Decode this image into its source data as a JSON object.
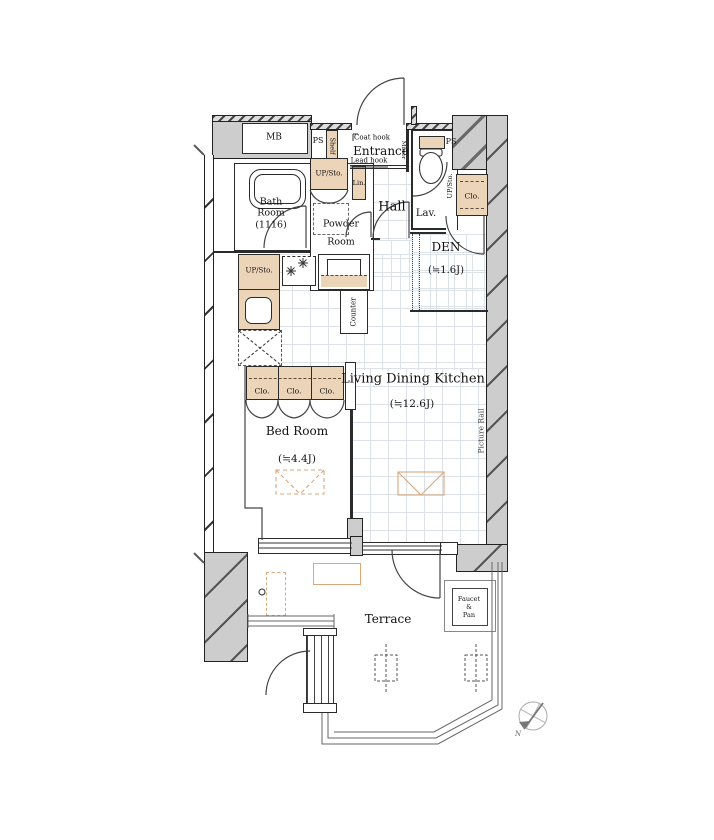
{
  "labels": {
    "mb": "MB",
    "ps_left": "PS",
    "ps_right": "PS",
    "shelf": "Shelf",
    "coat_hook": "Coat hook",
    "lead_hook": "Lead hook",
    "mirror": "Mirror",
    "entrance": "Entrance",
    "upsto_entrance": "UP/Sto.",
    "lin": "Lin.",
    "hall": "Hall",
    "lav": "Lav.",
    "upsto_lav": "UP/Sto.",
    "clo_lav": "Clo.",
    "bath_1": "Bath",
    "bath_2": "Room",
    "bath_3": "(1116)",
    "powder_1": "Powder",
    "powder_2": "Room",
    "den": "DEN",
    "den_size": "(≒1.6J)",
    "upsto_kitchen": "UP/Sto.",
    "counter": "Counter",
    "ldk": "Living Dining Kitchen",
    "ldk_size": "(≒12.6J)",
    "picture_rail": "Picture Rail",
    "clo_1": "Clo.",
    "clo_2": "Clo.",
    "clo_3": "Clo.",
    "bed": "Bed Room",
    "bed_size": "(≒4.4J)",
    "terrace": "Terrace",
    "faucet_1": "Faucet",
    "faucet_2": "&",
    "faucet_3": "Pan",
    "compass_n": "N"
  },
  "colors": {
    "wall_fill": "#cdcdcd",
    "storage_fill": "#ecd4b8",
    "accent_line": "#d9a77c",
    "grid_line": "#dde2e8"
  }
}
